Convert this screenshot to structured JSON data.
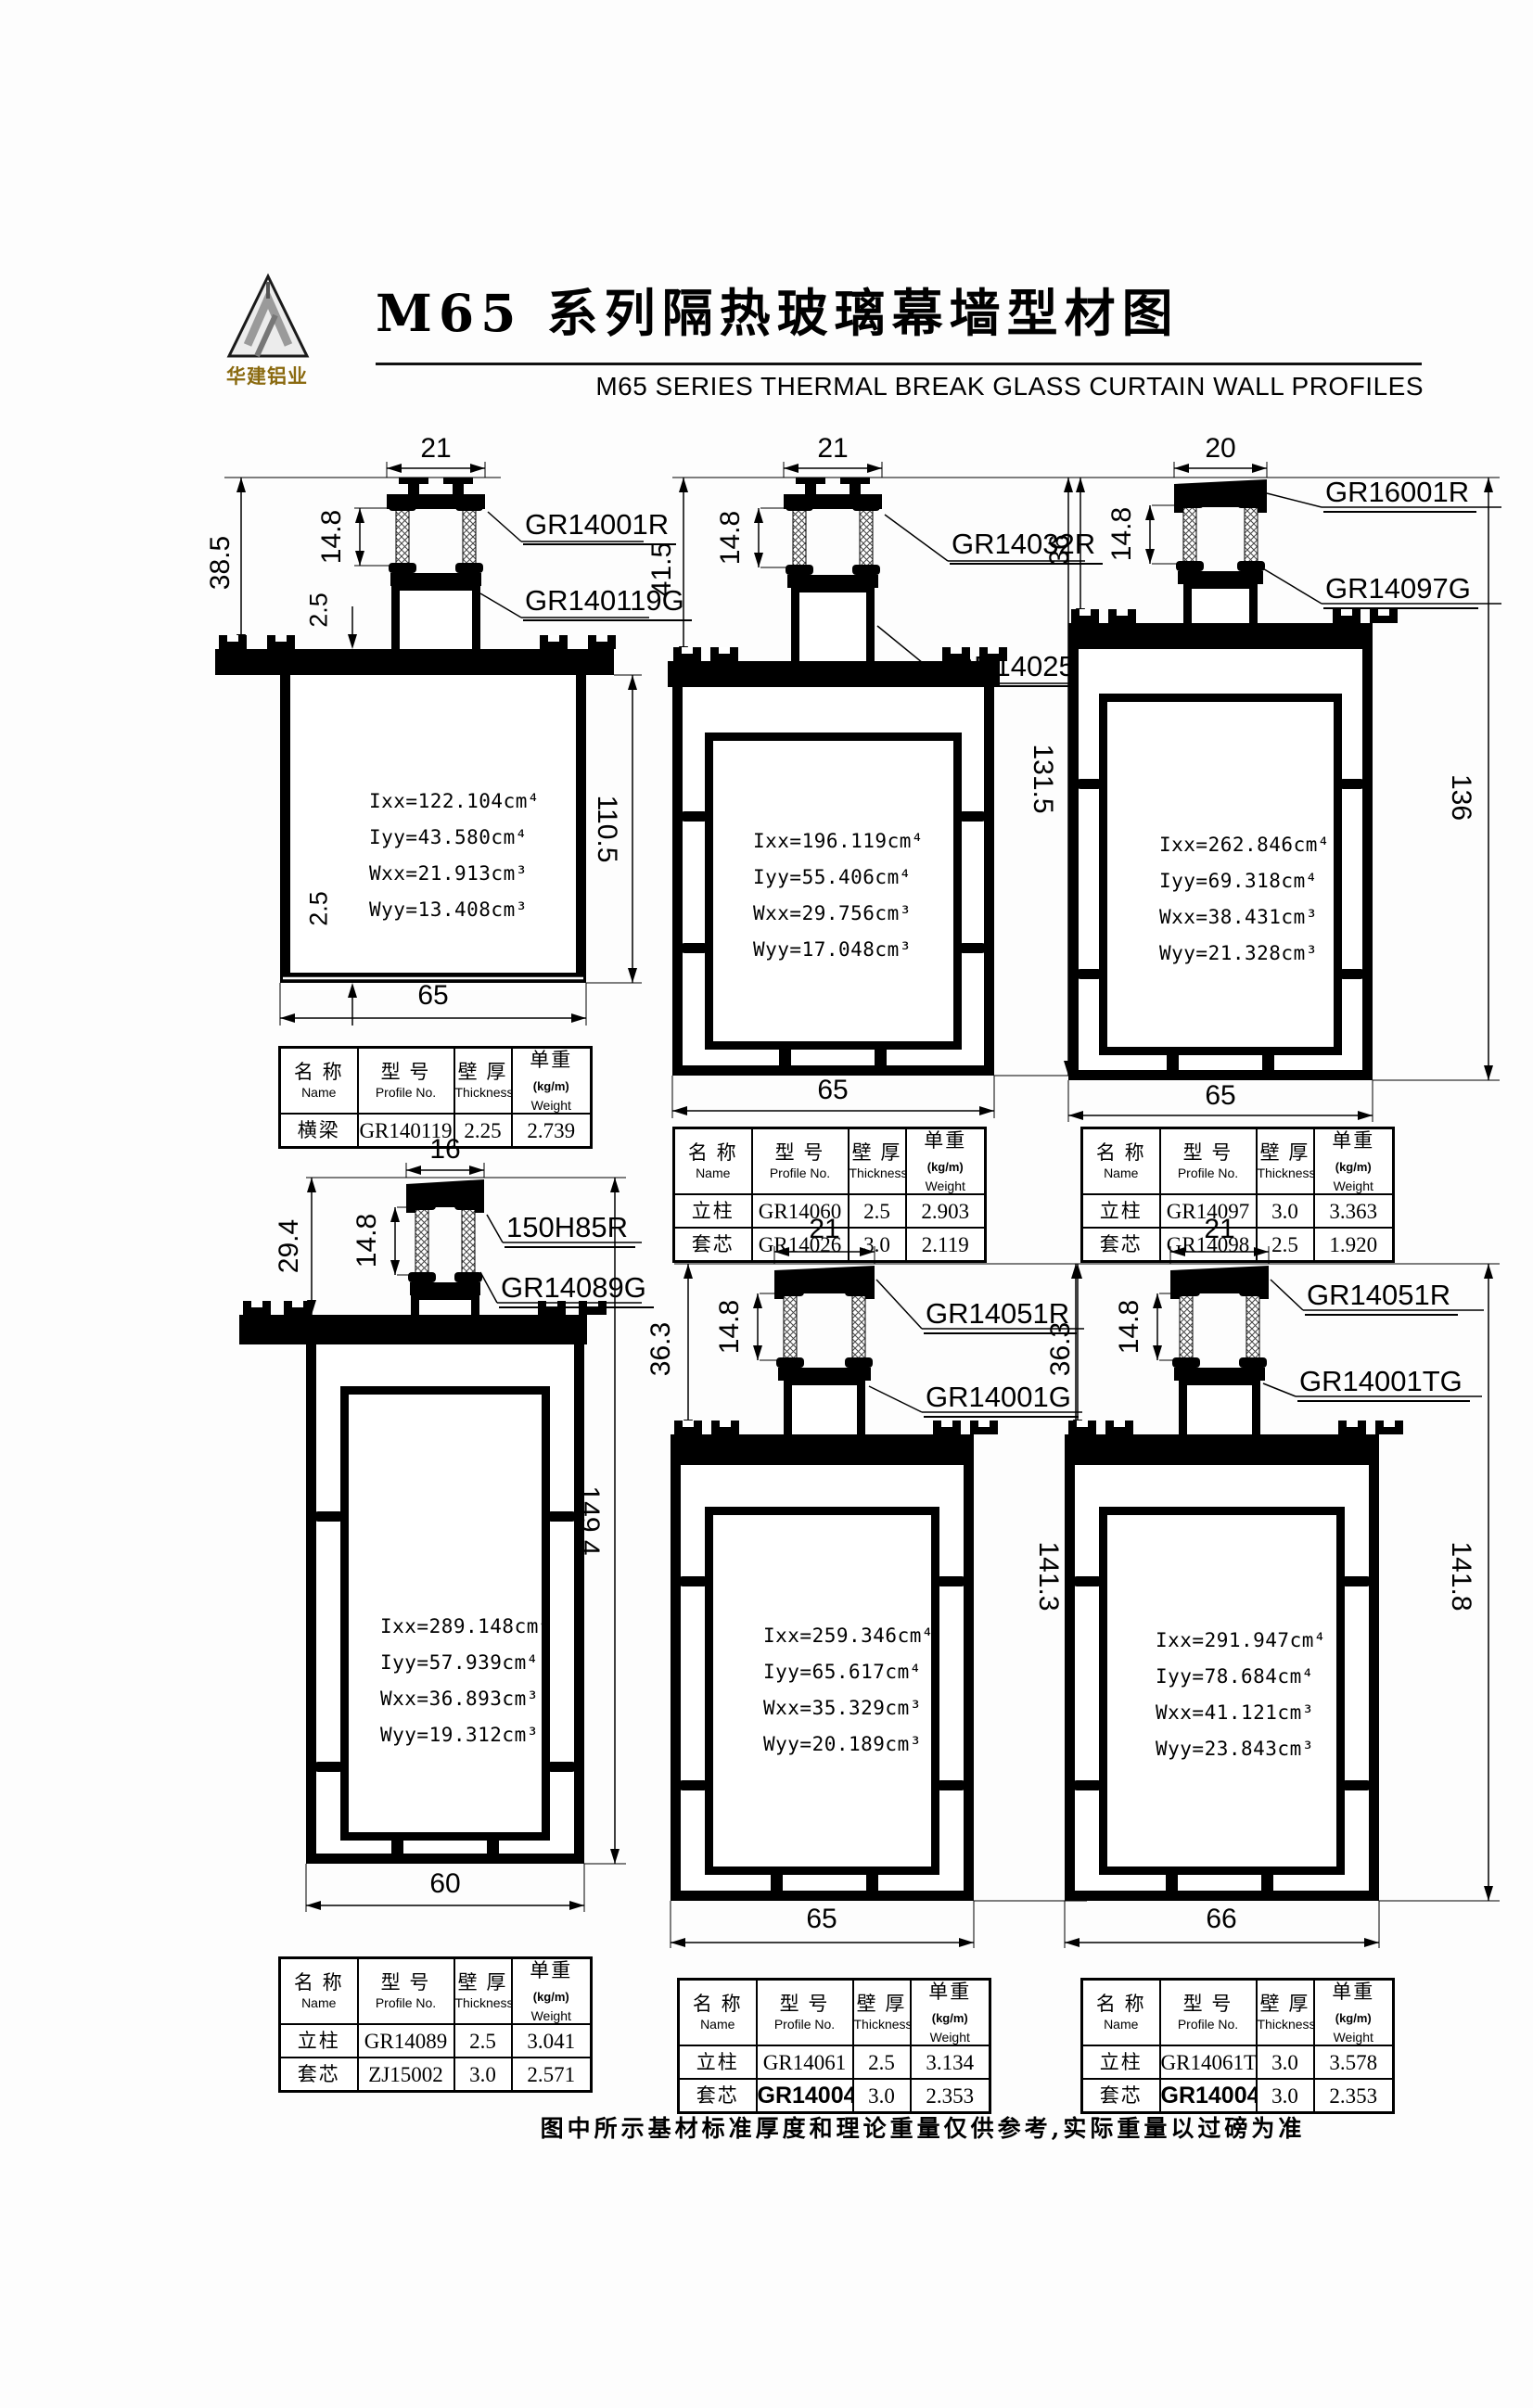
{
  "header": {
    "logo_text": "华建铝业",
    "title_cn": "M65 系列隔热玻璃幕墙型材图",
    "title_en": "M65  SERIES THERMAL BREAK GLASS CURTAIN WALL PROFILES"
  },
  "footer_note": "图中所示基材标准厚度和理论重量仅供参考,实际重量以过磅为准",
  "table_header": {
    "name_cn": "名 称",
    "name_en": "Name",
    "model_cn": "型 号",
    "model_en": "Profile No.",
    "thickness_cn": "壁 厚",
    "thickness_en": "Thickness",
    "weight_cn": "单重",
    "weight_unit": "(kg/m)",
    "weight_en": "Weight"
  },
  "profiles": [
    {
      "top_width": "21",
      "dim_left_main": "38.5",
      "dim_left_tb": "14.8",
      "dim_small_top": "2.5",
      "dim_small_bottom": "2.5",
      "dim_right": "110.5",
      "bottom_width": "65",
      "label_r": "GR14001R",
      "label_g": "GR140119G",
      "props": [
        "Ixx=122.104cm⁴",
        "Iyy=43.580cm⁴",
        "Wxx=21.913cm³",
        "Wyy=13.408cm³"
      ],
      "rows": [
        {
          "name": "横梁",
          "model": "GR140119",
          "thickness": "2.25",
          "weight": "2.739"
        }
      ]
    },
    {
      "top_width": "21",
      "dim_left_main": "41.5",
      "dim_left_tb": "14.8",
      "dim_right": "131.5",
      "bottom_width": "65",
      "label_r": "GR14032R",
      "label_g": "GR14025G",
      "props": [
        "Ixx=196.119cm⁴",
        "Iyy=55.406cm⁴",
        "Wxx=29.756cm³",
        "Wyy=17.048cm³"
      ],
      "rows": [
        {
          "name": "立柱",
          "model": "GR14060",
          "thickness": "2.5",
          "weight": "2.903"
        },
        {
          "name": "套芯",
          "model": "GR14026",
          "thickness": "3.0",
          "weight": "2.119"
        }
      ]
    },
    {
      "top_width": "20",
      "dim_left_main": "36",
      "dim_left_tb": "14.8",
      "dim_right": "136",
      "bottom_width": "65",
      "label_r": "GR16001R",
      "label_g": "GR14097G",
      "props": [
        "Ixx=262.846cm⁴",
        "Iyy=69.318cm⁴",
        "Wxx=38.431cm³",
        "Wyy=21.328cm³"
      ],
      "rows": [
        {
          "name": "立柱",
          "model": "GR14097",
          "thickness": "3.0",
          "weight": "3.363"
        },
        {
          "name": "套芯",
          "model": "GR14098",
          "thickness": "2.5",
          "weight": "1.920"
        }
      ]
    },
    {
      "top_width": "16",
      "dim_left_main": "29.4",
      "dim_left_tb": "14.8",
      "dim_right": "149.4",
      "bottom_width": "60",
      "label_r": "150H85R",
      "label_g": "GR14089G",
      "props": [
        "Ixx=289.148cm⁴",
        "Iyy=57.939cm⁴",
        "Wxx=36.893cm³",
        "Wyy=19.312cm³"
      ],
      "rows": [
        {
          "name": "立柱",
          "model": "GR14089",
          "thickness": "2.5",
          "weight": "3.041"
        },
        {
          "name": "套芯",
          "model": "ZJ15002",
          "thickness": "3.0",
          "weight": "2.571"
        }
      ]
    },
    {
      "top_width": "21",
      "dim_left_main": "36.3",
      "dim_left_tb": "14.8",
      "dim_right": "141.3",
      "bottom_width": "65",
      "label_r": "GR14051R",
      "label_g": "GR14001G",
      "props": [
        "Ixx=259.346cm⁴",
        "Iyy=65.617cm⁴",
        "Wxx=35.329cm³",
        "Wyy=20.189cm³"
      ],
      "rows": [
        {
          "name": "立柱",
          "model": "GR14061",
          "thickness": "2.5",
          "weight": "3.134"
        },
        {
          "name": "套芯",
          "model": "GR14004",
          "thickness": "3.0",
          "weight": "2.353",
          "bold": true
        }
      ]
    },
    {
      "top_width": "21",
      "dim_left_main": "36.3",
      "dim_left_tb": "14.8",
      "dim_right": "141.8",
      "bottom_width": "66",
      "label_r": "GR14051R",
      "label_g": "GR14001TG",
      "props": [
        "Ixx=291.947cm⁴",
        "Iyy=78.684cm⁴",
        "Wxx=41.121cm³",
        "Wyy=23.843cm³"
      ],
      "rows": [
        {
          "name": "立柱",
          "model": "GR14061T",
          "thickness": "3.0",
          "weight": "3.578"
        },
        {
          "name": "套芯",
          "model": "GR14004",
          "thickness": "3.0",
          "weight": "2.353",
          "bold": true
        }
      ]
    }
  ]
}
